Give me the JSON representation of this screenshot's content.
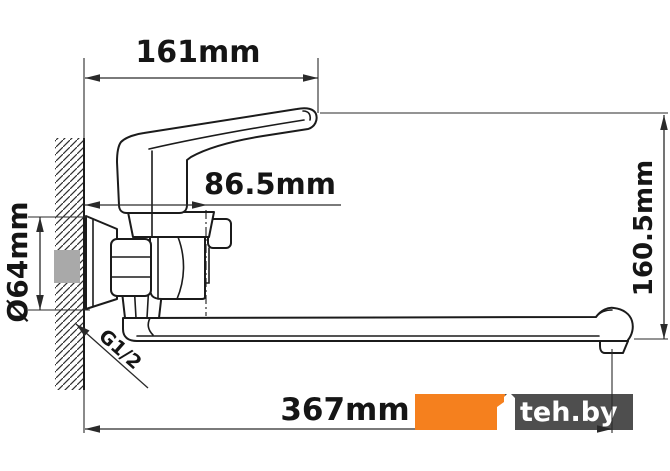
{
  "drawing": {
    "title": "Wall-mounted single-lever bath mixer — dimensional diagram",
    "dimensions": {
      "handle_reach": "161mm",
      "spout_axis_offset": "86.5mm",
      "flange_diameter": "Ø64mm",
      "overall_height": "160.5mm",
      "spout_reach": "367mm",
      "thread_size": "G1/2"
    }
  },
  "watermark": {
    "site": "teh.by",
    "logo_icon": "teh-by-numeral-1-icon",
    "orange_color": "#F5801E",
    "gray_color": "#4E4E4E"
  },
  "colors": {
    "line": "#1b1b1b",
    "dim_line": "#2a2a2a",
    "background": "#ffffff",
    "wall_pipe_fill": "#a9a9a9"
  }
}
